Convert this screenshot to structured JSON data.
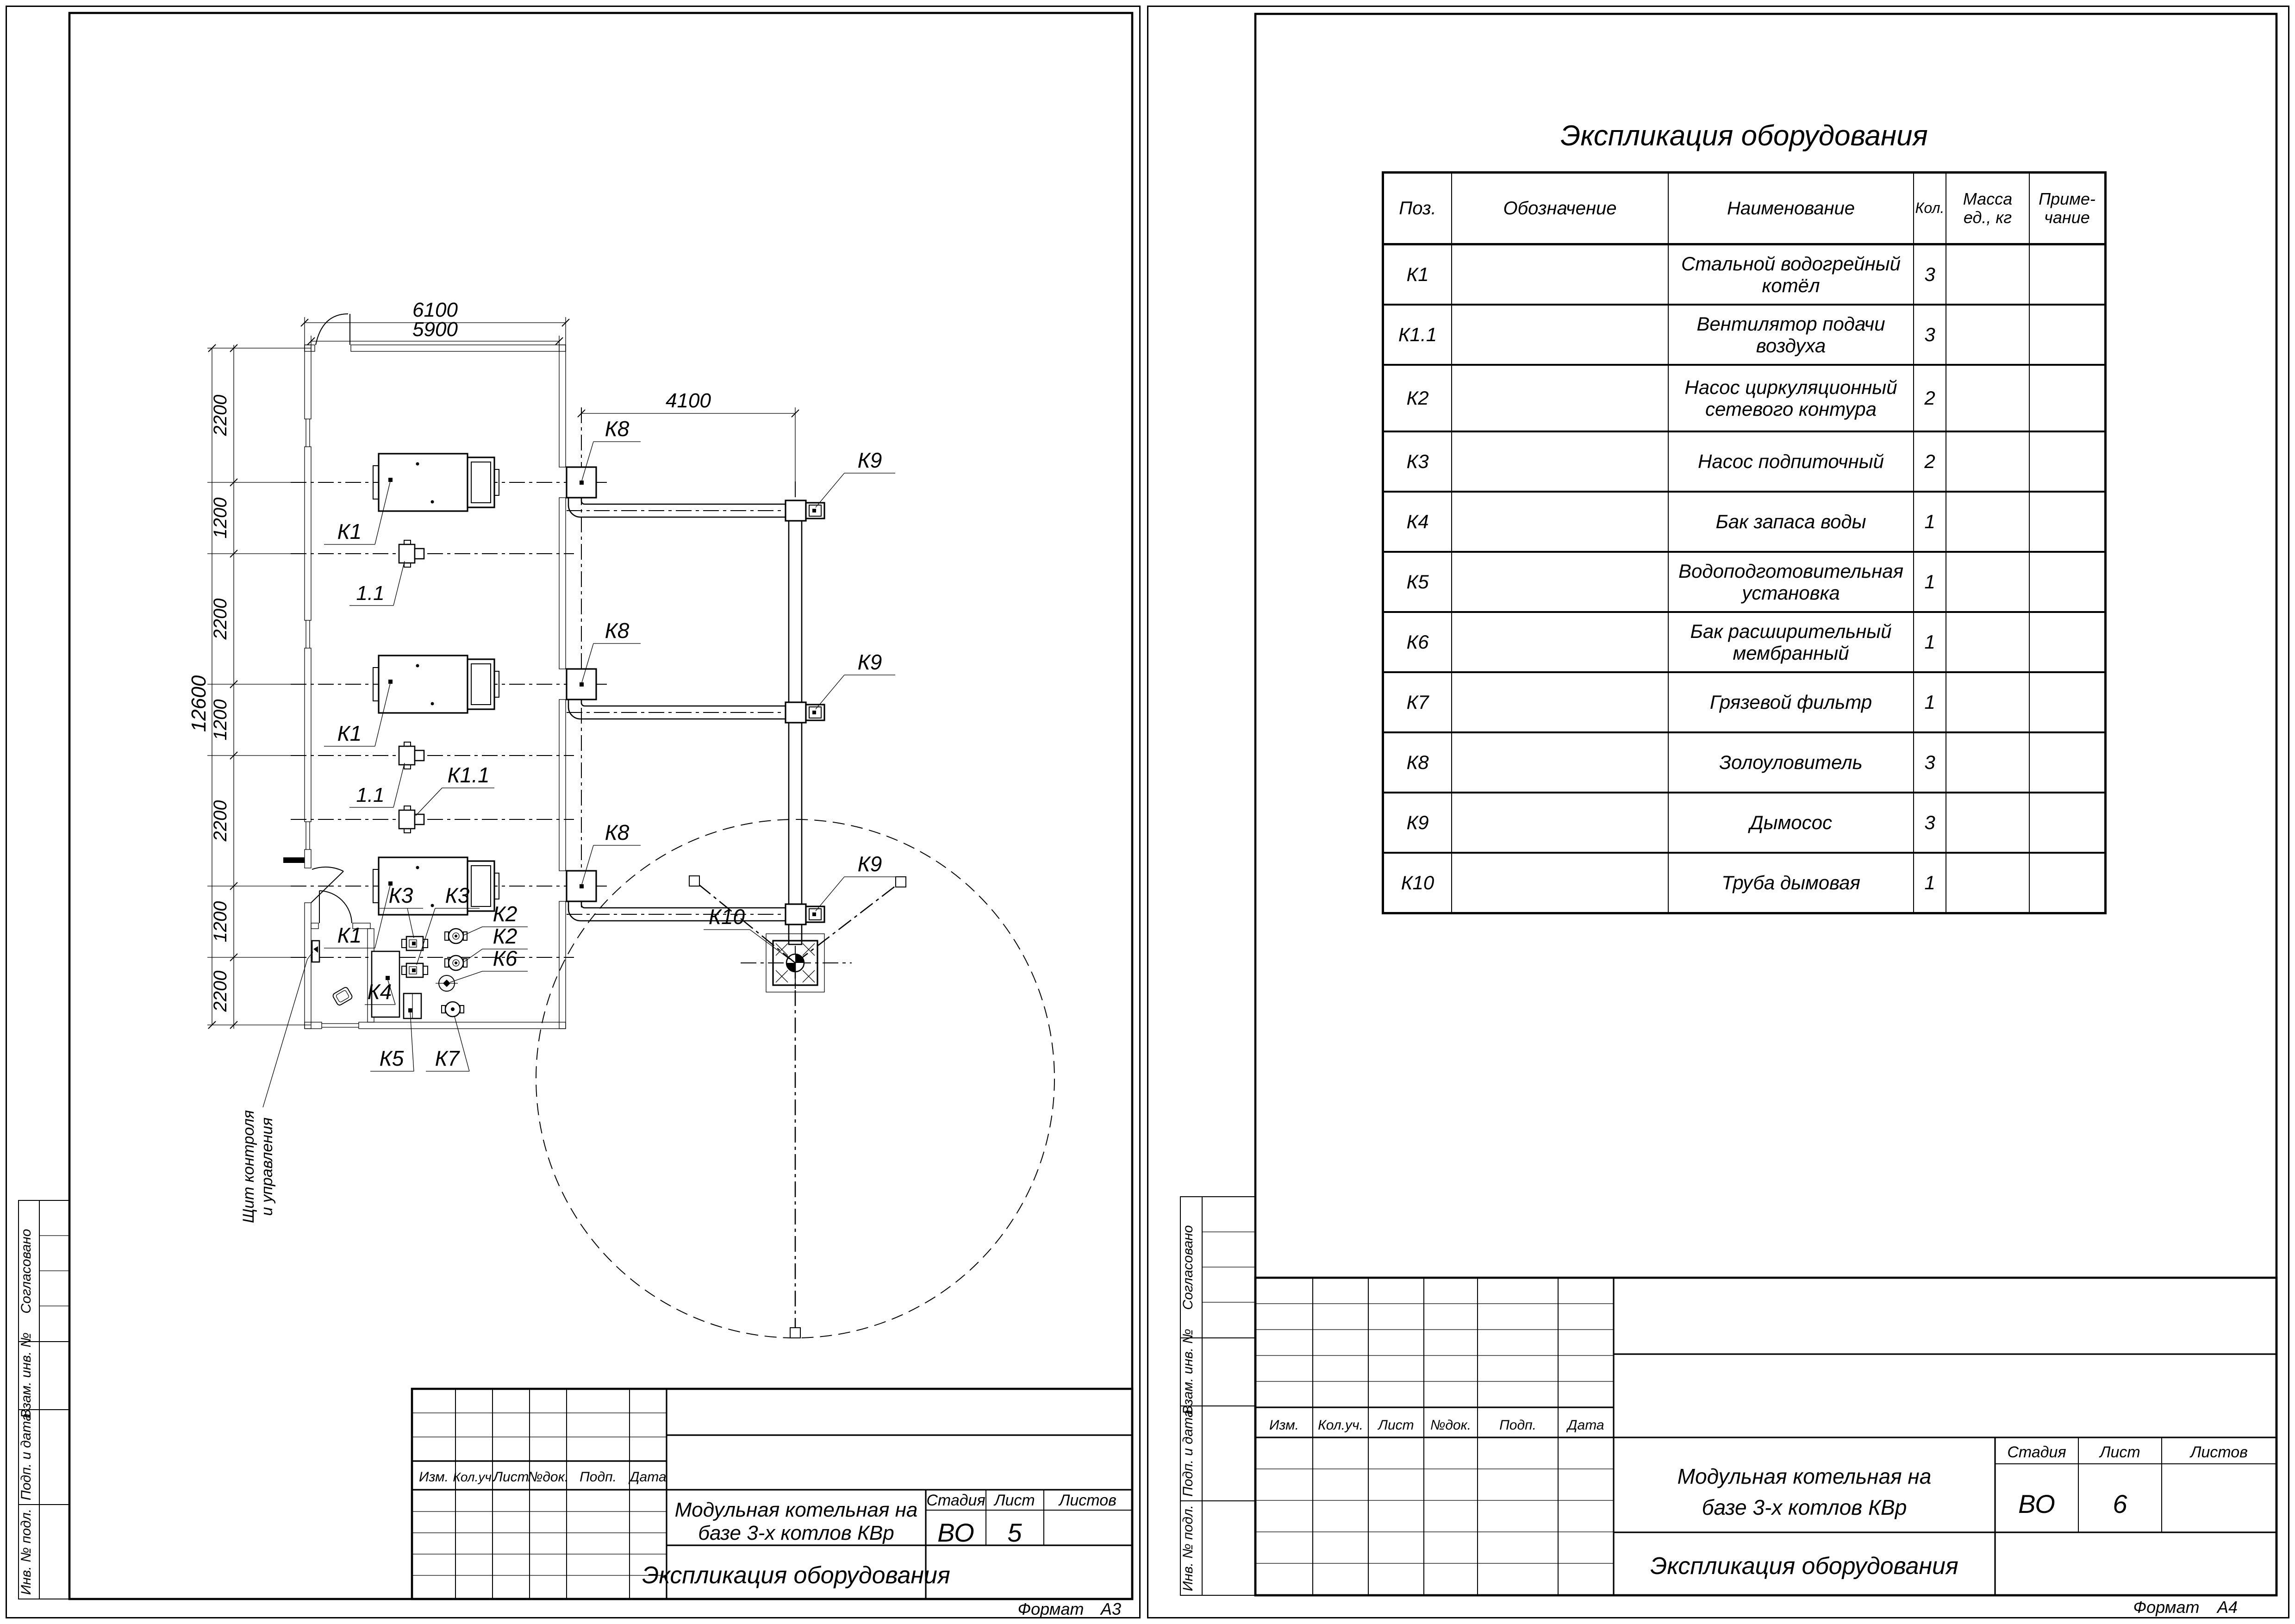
{
  "margin_labels": {
    "approved": "Согласовано",
    "repl_inv": "Взам. инв. №",
    "sign_date": "Подп. и дата",
    "inv_orig": "Инв. № подл."
  },
  "stamp": {
    "rev_headers": [
      "Изм.",
      "Кол.уч.",
      "Лист",
      "№док.",
      "Подп.",
      "Дата"
    ],
    "project_title_line1": "Модульная котельная на",
    "project_title_line2": "базе 3-х котлов КВр",
    "doc_title": "Экспликация оборудования",
    "stage_label": "Стадия",
    "sheet_label": "Лист",
    "sheets_label": "Листов",
    "stage_value": "ВО",
    "sheet_a3": "5",
    "sheet_a4": "6",
    "format_label": "Формат",
    "format_a3": "А3",
    "format_a4": "А4"
  },
  "equipment_table": {
    "title": "Экспликация оборудования",
    "headers": {
      "pos": "Поз.",
      "designation": "Обозначение",
      "name": "Наименование",
      "qty": "Кол.",
      "mass_l1": "Масса",
      "mass_l2": "ед., кг",
      "note_l1": "Приме-",
      "note_l2": "чание"
    },
    "rows": [
      {
        "pos": "К1",
        "designation": "",
        "name": "Стальной водогрейный котёл",
        "qty": "3",
        "mass": "",
        "note": ""
      },
      {
        "pos": "К1.1",
        "designation": "",
        "name": "Вентилятор подачи воздуха",
        "qty": "3",
        "mass": "",
        "note": ""
      },
      {
        "pos": "К2",
        "designation": "",
        "name": "Насос циркуляционный\nсетевого контура",
        "qty": "2",
        "mass": "",
        "note": ""
      },
      {
        "pos": "К3",
        "designation": "",
        "name": "Насос подпиточный",
        "qty": "2",
        "mass": "",
        "note": ""
      },
      {
        "pos": "К4",
        "designation": "",
        "name": "Бак запаса воды",
        "qty": "1",
        "mass": "",
        "note": ""
      },
      {
        "pos": "К5",
        "designation": "",
        "name": "Водоподготовительная установка",
        "qty": "1",
        "mass": "",
        "note": ""
      },
      {
        "pos": "К6",
        "designation": "",
        "name": "Бак расширительный мембранный",
        "qty": "1",
        "mass": "",
        "note": ""
      },
      {
        "pos": "К7",
        "designation": "",
        "name": "Грязевой фильтр",
        "qty": "1",
        "mass": "",
        "note": ""
      },
      {
        "pos": "К8",
        "designation": "",
        "name": "Золоуловитель",
        "qty": "3",
        "mass": "",
        "note": ""
      },
      {
        "pos": "К9",
        "designation": "",
        "name": "Дымосос",
        "qty": "3",
        "mass": "",
        "note": ""
      },
      {
        "pos": "К10",
        "designation": "",
        "name": "Труба дымовая",
        "qty": "1",
        "mass": "",
        "note": ""
      }
    ]
  },
  "plan": {
    "dims": {
      "width_outer": "6100",
      "width_inner": "5900",
      "duct_run": "4100",
      "height_total": "12600",
      "segments": [
        "2200",
        "1200",
        "2200",
        "1200",
        "2200",
        "1200",
        "2200"
      ]
    },
    "labels": {
      "boiler": "К1",
      "fan_short": "1.1",
      "fan": "К1.1",
      "pump_net": "К2",
      "pump_feed": "К3",
      "tank": "К4",
      "water_prep": "К5",
      "exp_tank": "К6",
      "filter": "К7",
      "ash_catcher": "К8",
      "smoke_exhauster": "К9",
      "chimney": "К10",
      "panel_l1": "Щит контроля",
      "panel_l2": "и управления"
    }
  }
}
